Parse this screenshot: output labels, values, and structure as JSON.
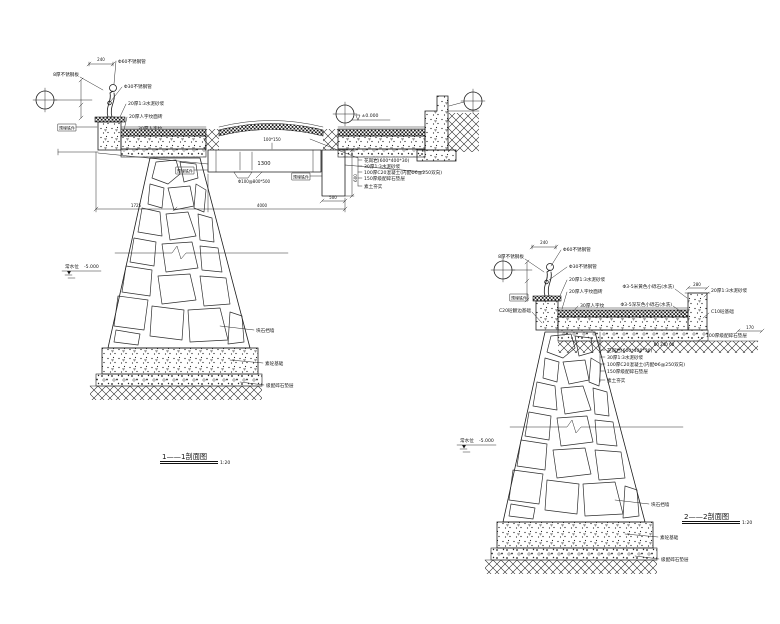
{
  "shared": {
    "dim_240": "240",
    "embed_tag": "预埋铁件",
    "scale": "1:20"
  },
  "railing_labels": {
    "plate": "8厚不锈钢板",
    "pipe60": "Φ60不锈钢管",
    "pipe30": "Φ30不锈钢管",
    "mortar": "20厚1:3水泥砂浆",
    "tile20": "20厚人字纹面砖",
    "tile30": "30厚人字纹"
  },
  "pavement_layers": [
    "花岗岩(600*400*30)",
    "30厚1:3水泥砂浆",
    "100厚C20混凝土(内配Φ6@250双向)",
    "150厚级配碎石垫层",
    "素土夯实"
  ],
  "pier_labels": {
    "rubble_wall": "块石挡墙",
    "plain_footing": "素砼基础",
    "gravel_cushion": "级配碎石垫层"
  },
  "water": {
    "name": "常水位",
    "level": "-5.000"
  },
  "section1": {
    "caption": "1——1剖面图",
    "elevation_zero": "±0.000",
    "beam_dim": "1300",
    "beam_size": "100*150",
    "beam_note": "Φ100@800*500",
    "dim_1725": "1725",
    "dim_4000": "4000",
    "dim_500": "500",
    "dim_600": "600"
  },
  "section2": {
    "caption": "2——2剖面图",
    "dim_280": "280",
    "dim_170": "170",
    "dim_triple": "60 240 60",
    "labels": {
      "c20_edge": "C20砼翻边基础",
      "pebble_yellow": "Φ3-5米黄色小砾石(水洗)",
      "pebble_grey": "Φ3-5深灰色小砾石(水洗)",
      "mortar_right": "20厚1:3水泥砂浆",
      "c10_footing": "C10砼基础",
      "gravel_100": "100厚级配碎石垫层"
    }
  }
}
